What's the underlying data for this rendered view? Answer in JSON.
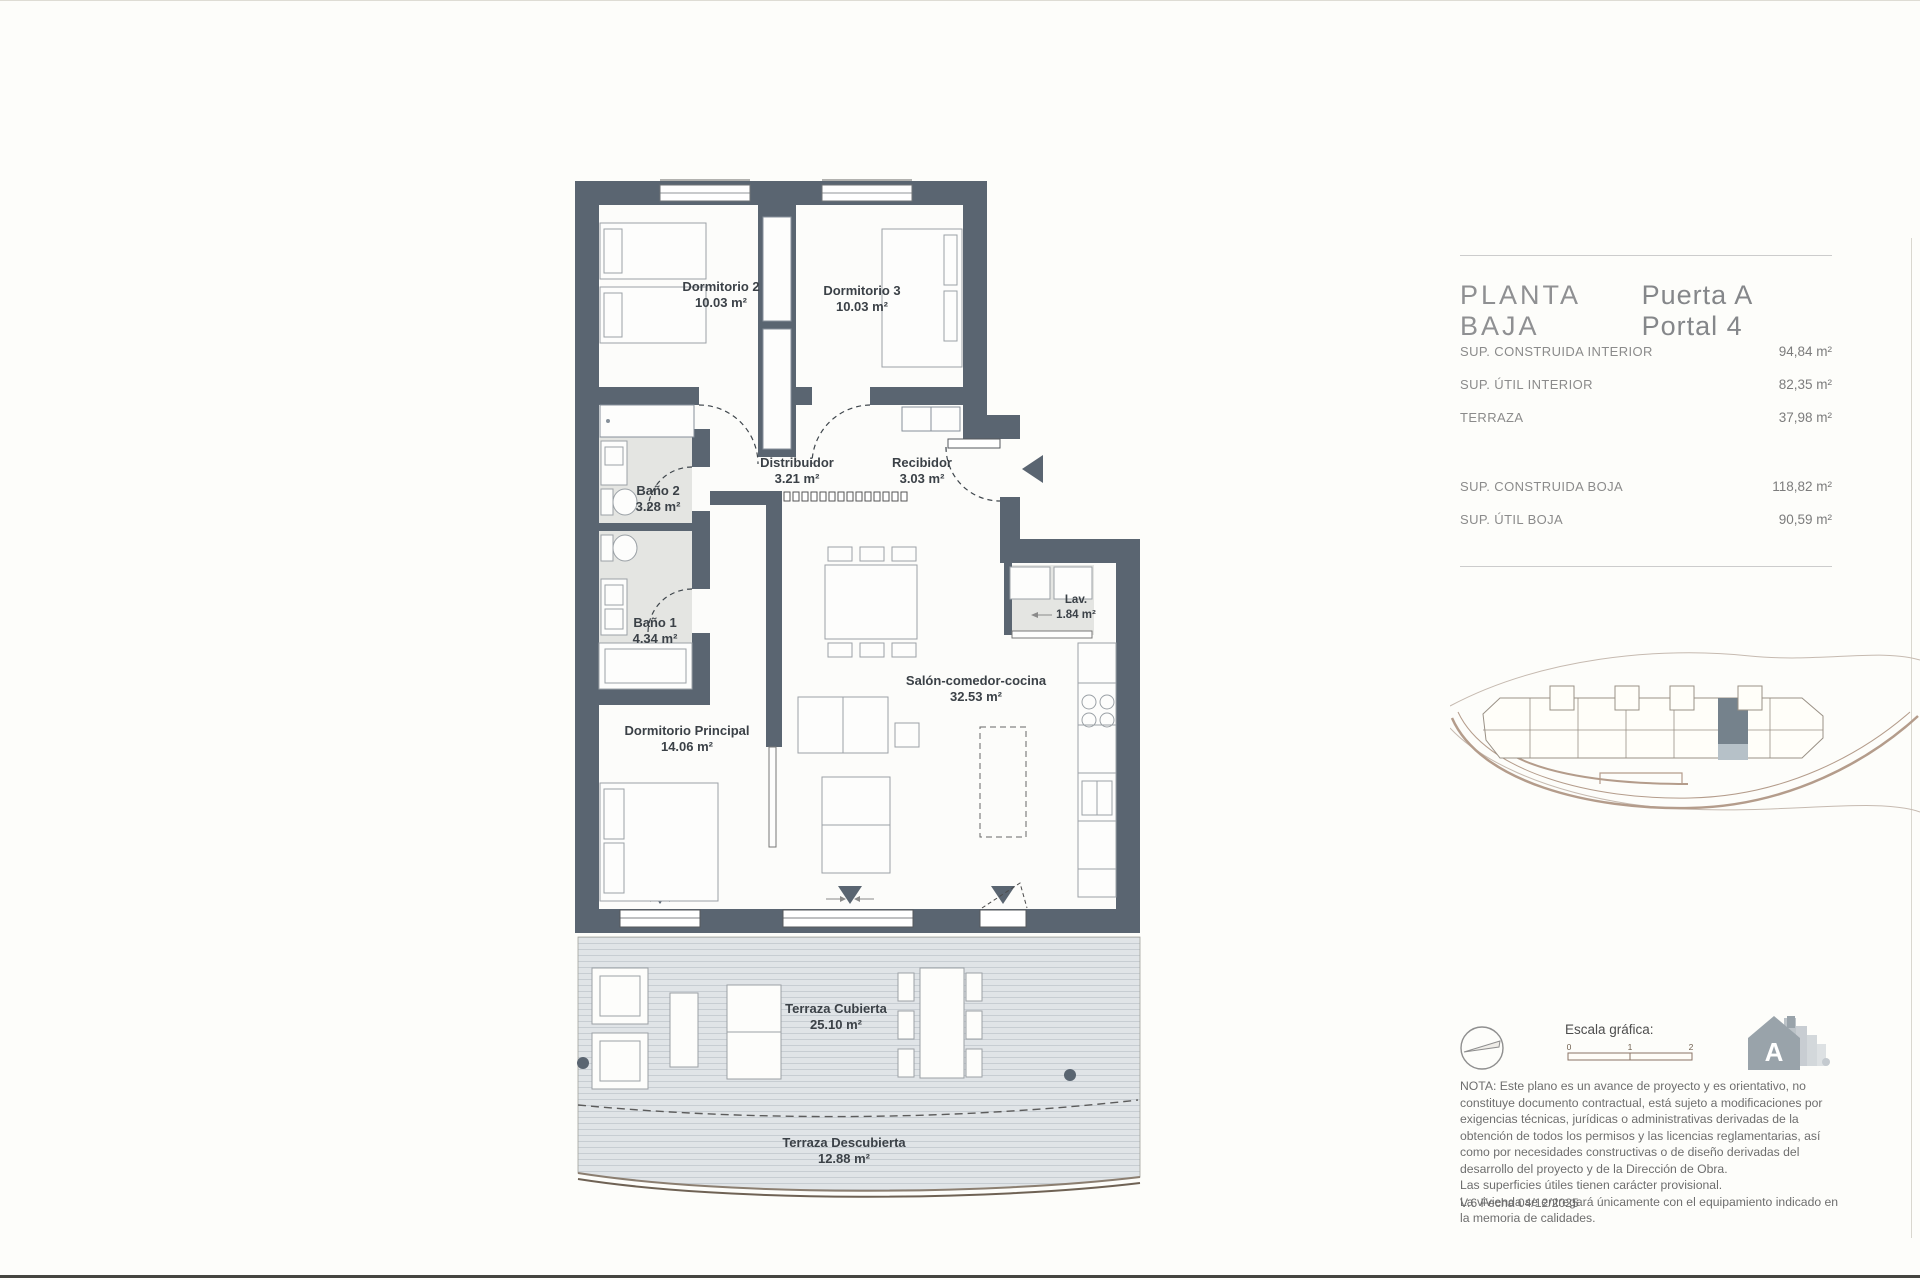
{
  "panel": {
    "title_left": "PLANTA BAJA",
    "title_right": "Puerta A Portal 4",
    "areas_interior": [
      {
        "label": "SUP. CONSTRUIDA INTERIOR",
        "value": "94,84 m²"
      },
      {
        "label": "SUP. ÚTIL INTERIOR",
        "value": "82,35 m²"
      },
      {
        "label": "TERRAZA",
        "value": "37,98 m²"
      }
    ],
    "areas_total": [
      {
        "label": "SUP. CONSTRUIDA BOJA",
        "value": "118,82 m²"
      },
      {
        "label": "SUP. ÚTIL BOJA",
        "value": "90,59 m²"
      }
    ],
    "scale_label": "Escala gráfica:",
    "scale_ticks": [
      "0",
      "1",
      "2"
    ],
    "energy_letter": "A",
    "note_paragraph": "NOTA: Este plano es un avance de proyecto y es orientativo, no constituye documento contractual, está sujeto a modificaciones por exigencias técnicas, jurídicas o administrativas derivadas de la obtención de todos los permisos y las licencias reglamentarias, así como por necesidades constructivas o de diseño derivadas del desarrollo del proyecto y de la Dirección de Obra.",
    "note_line2": "Las superficies útiles tienen carácter provisional.",
    "note_line3": "La vivienda se entregará únicamente con el equipamiento indicado en la memoria de calidades.",
    "version": "V.6 Fecha 04/12/2025"
  },
  "plan": {
    "rooms": [
      {
        "name": "Dormitorio 2",
        "area": "10.03 m²"
      },
      {
        "name": "Dormitorio 3",
        "area": "10.03 m²"
      },
      {
        "name": "Baño 2",
        "area": "3.28 m²"
      },
      {
        "name": "Baño 1",
        "area": "4.34 m²"
      },
      {
        "name": "Distribuidor",
        "area": "3.21 m²"
      },
      {
        "name": "Recibidor",
        "area": "3.03 m²"
      },
      {
        "name": "Lav.",
        "area": "1.84 m²"
      },
      {
        "name": "Salón-comedor-cocina",
        "area": "32.53 m²"
      },
      {
        "name": "Dormitorio Principal",
        "area": "14.06 m²"
      },
      {
        "name": "Terraza Cubierta",
        "area": "25.10 m²"
      },
      {
        "name": "Terraza Descubierta",
        "area": "12.88 m²"
      }
    ],
    "colors": {
      "wall": "#5a6571",
      "bath_floor": "#e4e5e2",
      "terrace_deck": "#e0e4e7"
    }
  }
}
